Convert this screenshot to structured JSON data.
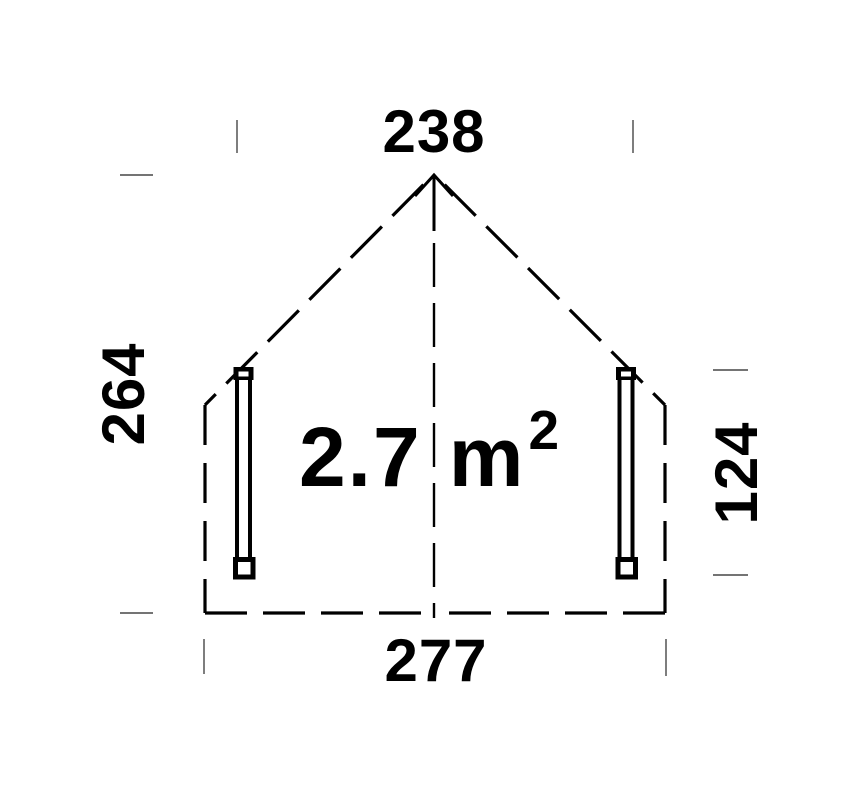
{
  "dimensions": {
    "top": "238",
    "left": "264",
    "right": "124",
    "bottom": "277"
  },
  "area": {
    "value": "2.7",
    "unit": "m",
    "exponent": "2"
  },
  "icons": {
    "ridge_arrow": "up-arrow"
  },
  "colors": {
    "line": "#000000",
    "tick": "#474747",
    "background": "#ffffff"
  }
}
